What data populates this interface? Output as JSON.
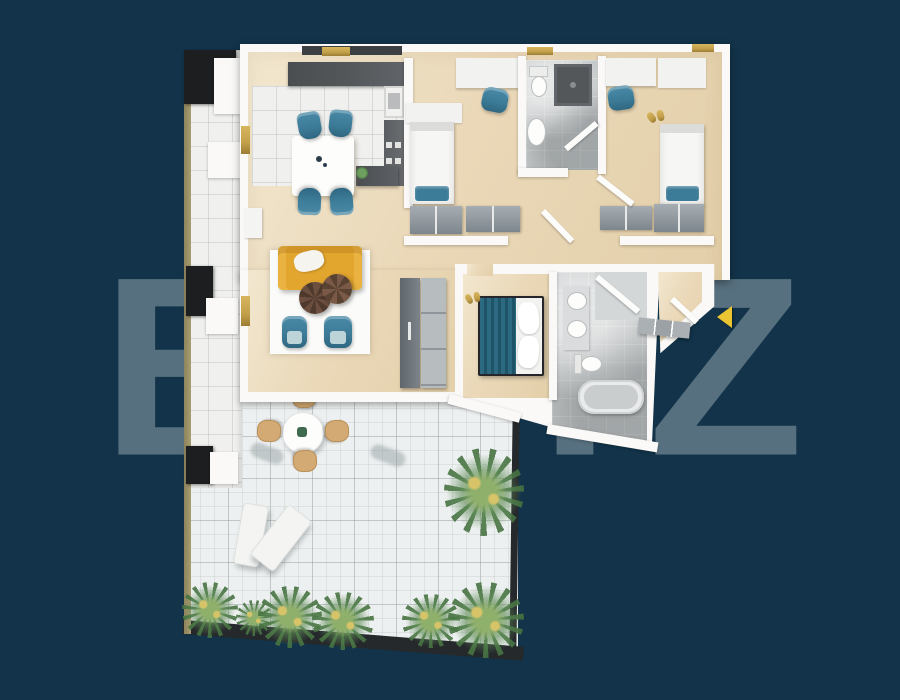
{
  "watermark": {
    "text": "BLITZ"
  },
  "scene": {
    "type": "apartment-floor-plan-3d-render",
    "rooms": [
      "living-room",
      "kitchen",
      "bedroom-1",
      "bedroom-2",
      "bathroom",
      "hallway",
      "master-bedroom",
      "master-bathroom",
      "entrance",
      "balcony",
      "terrace"
    ],
    "markers": {
      "entrance_arrow": "yellow triangle pointing left at apartment entrance"
    }
  },
  "colors": {
    "bg": "#123349",
    "watermark": "#57707f",
    "wall": "#faf9f7",
    "wall_dark": "#26292c",
    "wood_a": "#ead8b8",
    "wood_b": "#e3cfa9",
    "tile_white": "#f0f0ee",
    "tile_gray": "#c6c9ca",
    "terrace_tile": "#edf0f0",
    "counter": "#54575a",
    "gold": "#c2a04a",
    "teal": "#3d7c98",
    "teal_dark": "#2b6a80",
    "sofa": "#e2a52e",
    "wardrobe_a": "#a6adb2",
    "wardrobe_b": "#7e868d",
    "rug": "#fbfbfa",
    "coffee": "#6b4e3e",
    "plant": "#5d8a55",
    "plant_light": "#8fb06a",
    "arrow": "#e8c531",
    "lounger": "#f4f5f3",
    "chair_tan": "#d3aa74",
    "rail": "#a89e72"
  }
}
